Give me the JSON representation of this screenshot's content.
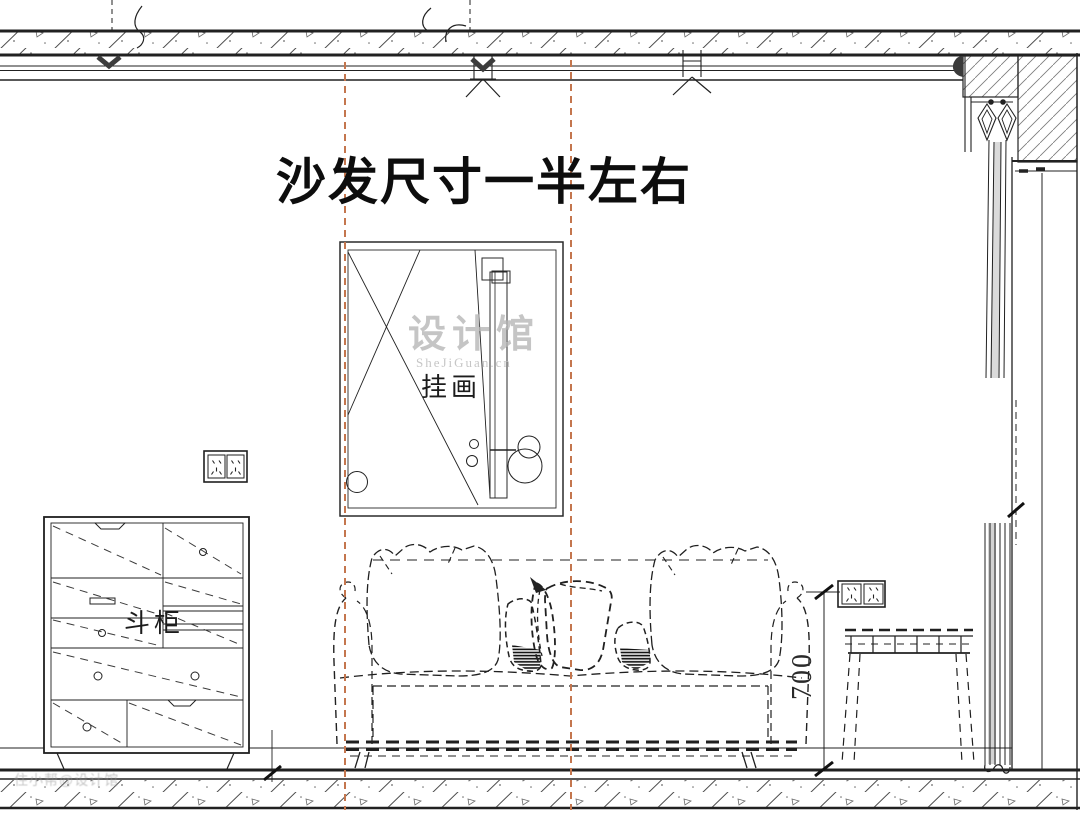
{
  "drawing": {
    "title": "沙发尺寸一半左右",
    "labels": {
      "picture_frame": "挂画",
      "cabinet": "斗柜"
    },
    "dimensions": {
      "side_table_height": "700"
    },
    "watermark": {
      "brand": "设计馆",
      "site": "SheJiGuan.cn",
      "corner": "住小帮@设计馆"
    },
    "colors": {
      "guide_orange": "#c4764e",
      "line_black": "#212121",
      "hanger_gray": "#3c3c3c",
      "watermark_gray": "#b5b5b5"
    }
  }
}
